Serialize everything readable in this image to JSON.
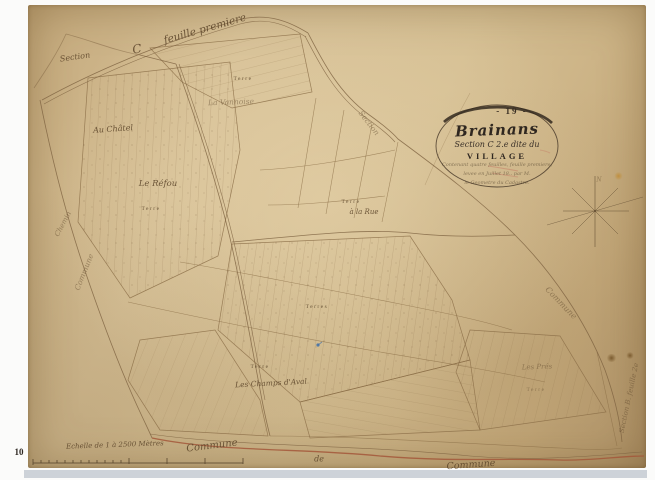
{
  "palette": {
    "paper": "#d3bd92",
    "paper_edge": "#b2966c",
    "ink": "#7c6240",
    "boundary_red": "#a3573a",
    "stamp_dark": "#2c2620",
    "blue_mark": "#3f6fa8"
  },
  "cartouche": {
    "page_number": "- 19 -",
    "commune_name": "Brainans",
    "section_line": "Section C 2.e dite du",
    "place_name": "VILLAGE",
    "note_line_1": "Contenant quatre feuilles, feuille premiere,",
    "note_line_2": "levee en Juillet 18.. par M.",
    "note_line_3": "le Geometre du Cadastre."
  },
  "edge_labels": {
    "top_section": "Section",
    "feuille_initial": "C",
    "feuille_arc": "feuille premiere",
    "right_section": "Section",
    "right_commune": "Commune",
    "right_margin_feuille": "Section B. feuille 2e",
    "left_chemin": "Chemin",
    "left_commune": "Commune",
    "bottom_commune_west": "Commune",
    "bottom_de": "de",
    "bottom_commune_east": "Commune",
    "compass_north": "N"
  },
  "lieu_dits": {
    "au_chatel": "Au Châtel",
    "la_vannoise": "La Vannoise",
    "le_refou": "Le Réfou",
    "a_la_rue": "à la Rue",
    "champs_aval": "Les Champs d'Aval",
    "les_pres": "Les Prés"
  },
  "parcel_labels": {
    "terre": "Terre",
    "terres": "Terres"
  },
  "scale_bar": {
    "caption": "Echelle de 1 à 2500 Mètres"
  },
  "stamps": {
    "bottom_left_number": "10"
  }
}
